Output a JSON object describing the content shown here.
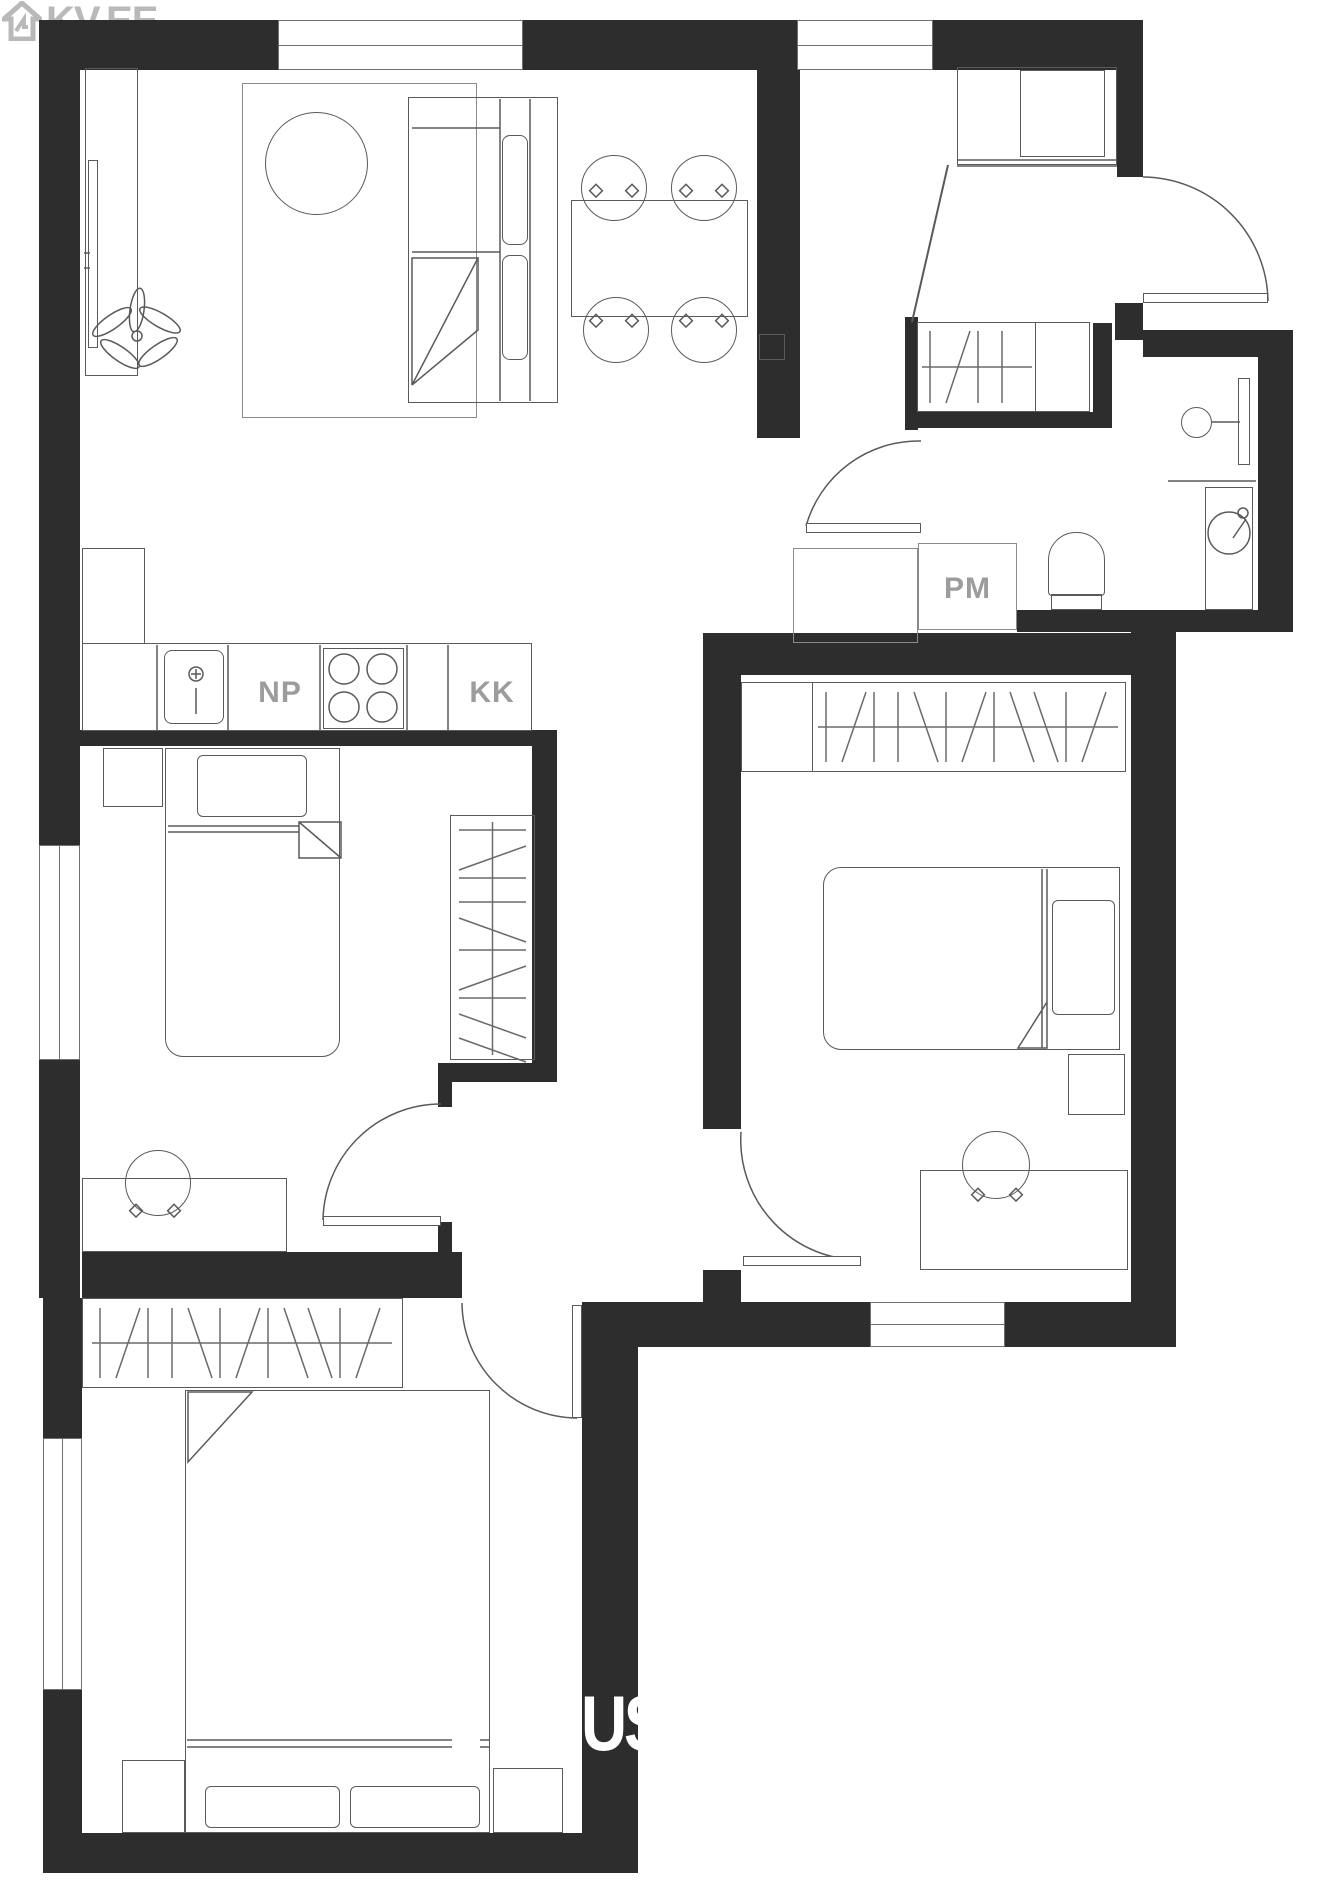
{
  "branding": {
    "logo_text": "KV.EE",
    "logo_icon": "house-arrow-icon",
    "logo_color": "#b9b9b9"
  },
  "watermark": {
    "text": "US",
    "color": "#ffffff"
  },
  "labels": {
    "dishwasher": "NP",
    "fridge": "KK",
    "storage": "PM"
  },
  "colors": {
    "wall": "#2d2d2d",
    "furniture_line": "#5a5a5a",
    "furniture_line_light": "#8a8a8a",
    "label_text": "#9c9c9c",
    "background": "#ffffff"
  },
  "legend": {
    "type": "floor-plan",
    "rooms": [
      "living-room-kitchen",
      "entrance-hall",
      "bathroom",
      "bedroom-left",
      "bedroom-right",
      "bedroom-bottom",
      "corridor"
    ],
    "fixtures": [
      "kitchen-sink",
      "stove",
      "dishwasher-NP",
      "fridge-KK",
      "storage-PM",
      "washing-machine",
      "toilet",
      "bathroom-sink",
      "wardrobes-hatched",
      "beds",
      "dining-table",
      "desks",
      "plant",
      "tv-bench"
    ]
  }
}
